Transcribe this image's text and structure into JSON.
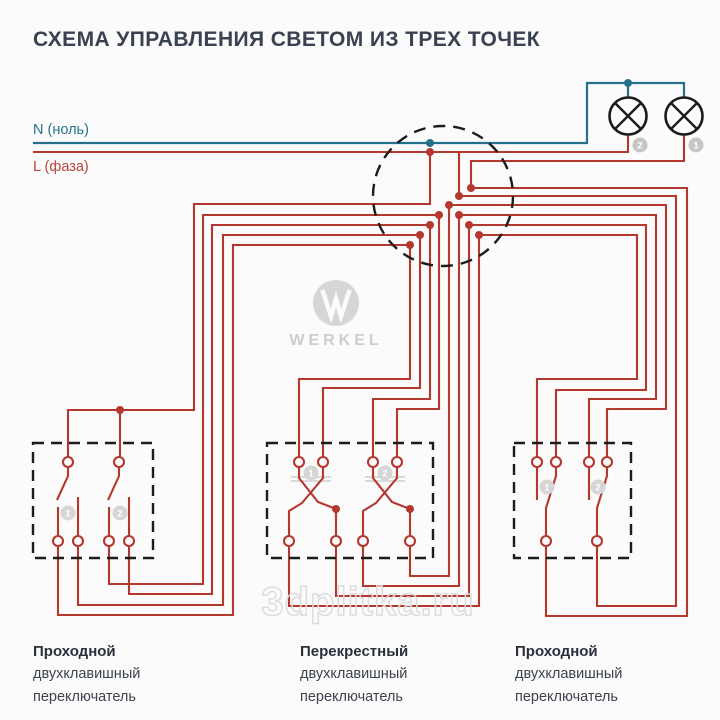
{
  "title": "СХЕМА УПРАВЛЕНИЯ СВЕТОМ ИЗ ТРЕХ ТОЧЕК",
  "legend": {
    "neutral_label": "N (ноль)",
    "phase_label": "L (фаза)"
  },
  "colors": {
    "phase_wire": "#b5382f",
    "neutral_wire": "#26718a",
    "outline_black": "#1c1c1c",
    "badge_gray": "#c6c6c6",
    "logo_gray": "#d6d6d6",
    "watermark_gray": "#dcdcdc"
  },
  "lamps": [
    {
      "badge": "2"
    },
    {
      "badge": "1"
    }
  ],
  "switches": [
    {
      "badges": [
        "1",
        "2"
      ],
      "label_lines": [
        "Проходной",
        "двухклавишный",
        "переключатель"
      ]
    },
    {
      "badges": [
        "1",
        "2"
      ],
      "label_lines": [
        "Перекрестный",
        "двухклавишный",
        "переключатель"
      ]
    },
    {
      "badges": [
        "1",
        "2"
      ],
      "label_lines": [
        "Проходной",
        "двухклавишный",
        "переключатель"
      ]
    }
  ],
  "logo": {
    "brand": "WERKEL"
  },
  "watermark": "3dplitka.ru"
}
